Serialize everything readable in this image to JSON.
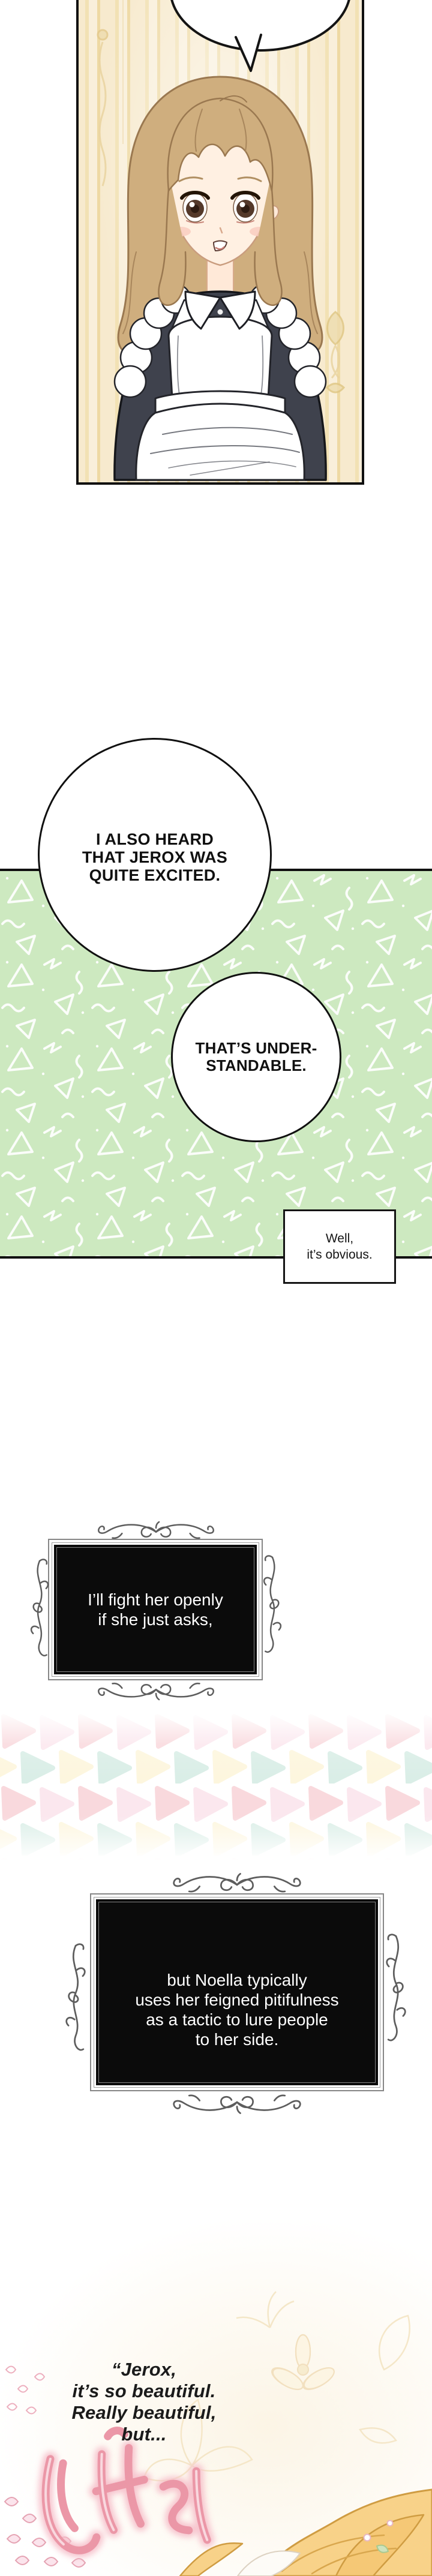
{
  "speech": {
    "bubble1": {
      "lines": [
        "I ALSO HEARD",
        "THAT JEROX WAS",
        "QUITE EXCITED."
      ]
    },
    "bubble2": {
      "lines": [
        "THAT’S UNDER-",
        "STANDABLE."
      ]
    },
    "caption": {
      "lines": [
        "Well,",
        "it’s obvious."
      ]
    }
  },
  "narration": {
    "box1": {
      "lines": [
        "I’ll fight her openly",
        "if she just asks,"
      ]
    },
    "box2": {
      "lines": [
        "but Noella typically",
        "uses her feigned pitifulness",
        "as a tactic to lure people",
        "to her side."
      ]
    }
  },
  "monologue": {
    "lines": [
      "“Jerox,",
      "it’s so beautiful.",
      "Really beautiful,",
      "but..."
    ]
  },
  "decor": {
    "top_panel": "maid-character-closeup",
    "top_bubble": "empty-speech-bubble-cropped",
    "frame_ornament": "scroll-flourish",
    "green_pattern": "white-triangles-squiggles-dots",
    "pastel_pattern": "pastel-triangle-rows",
    "sfx": "pink-glow-hand-lettering",
    "bottom_corner": "blonde-character-hair-and-flowers"
  },
  "colors": {
    "green_bg": "#cde9c0",
    "panel_border": "#101010",
    "black_box": "#0b0b0b",
    "frame_gray": "#868686",
    "ornament_gray": "#5d5d5d",
    "wallpaper_base": "#f7eace",
    "wallpaper_stripe": "#eed9a3",
    "pastel_pink": "#f9d9dd",
    "pastel_rose": "#fbe7ee",
    "pastel_mint": "#daeee7",
    "pastel_yellow": "#fdf6de",
    "sfx_pink": "#eb97a7",
    "hair_gold": "#f8d289",
    "maid_hair_brown": "#cfae7e",
    "maid_dress_dark": "#3f424d"
  }
}
